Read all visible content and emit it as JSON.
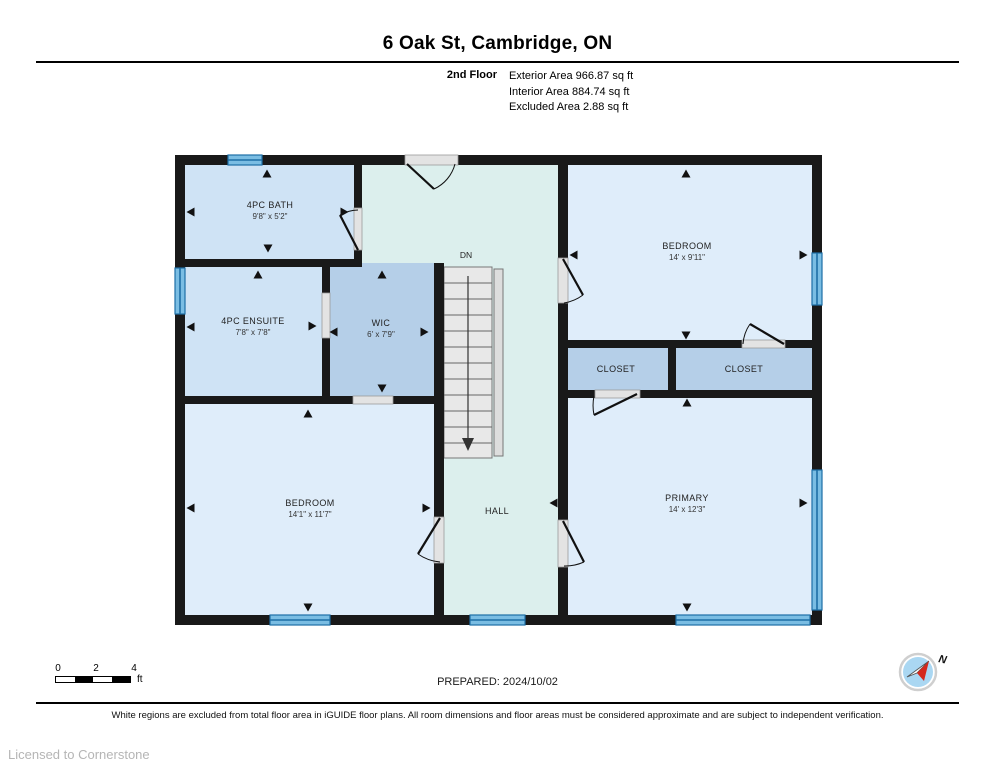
{
  "header": {
    "title": "6 Oak St, Cambridge, ON",
    "floor_label": "2nd Floor",
    "area_lines": [
      "Exterior Area 966.87 sq ft",
      "Interior Area 884.74 sq ft",
      "Excluded Area 2.88 sq ft"
    ]
  },
  "plan": {
    "rooms": [
      {
        "name": "4PC BATH",
        "dims": "9'8\" x 5'2\""
      },
      {
        "name": "4PC ENSUITE",
        "dims": "7'8\" x 7'8\""
      },
      {
        "name": "WIC",
        "dims": "6' x 7'9\""
      },
      {
        "name": "BEDROOM",
        "dims": "14' x 9'11\""
      },
      {
        "name": "CLOSET",
        "dims": ""
      },
      {
        "name": "CLOSET",
        "dims": ""
      },
      {
        "name": "BEDROOM",
        "dims": "14'1\" x 11'7\""
      },
      {
        "name": "HALL",
        "dims": ""
      },
      {
        "name": "PRIMARY",
        "dims": "14' x 12'3\""
      }
    ],
    "stairs_label": "DN",
    "compass_label": "N"
  },
  "footer": {
    "scale_ticks": [
      "0",
      "2",
      "4"
    ],
    "scale_unit": "ft",
    "prepared": "PREPARED: 2024/10/02",
    "disclaimer": "White regions are excluded from total floor area in iGUIDE floor plans. All room dimensions and floor areas must be considered approximate and are subject to independent verification.",
    "license": "Licensed to Cornerstone"
  },
  "colors": {
    "wall": "#191919",
    "room_blue": "#cfe3f5",
    "room_medium_blue": "#b5cfe8",
    "room_pale_blue": "#dfedfa",
    "hall_cyan": "#dcefed",
    "window_blue": "#7abde3",
    "window_stripe": "#1d6fa6",
    "stairs_grey": "#e8e8e8",
    "compass_blue": "#aad7f2",
    "compass_red": "#d4281c"
  }
}
